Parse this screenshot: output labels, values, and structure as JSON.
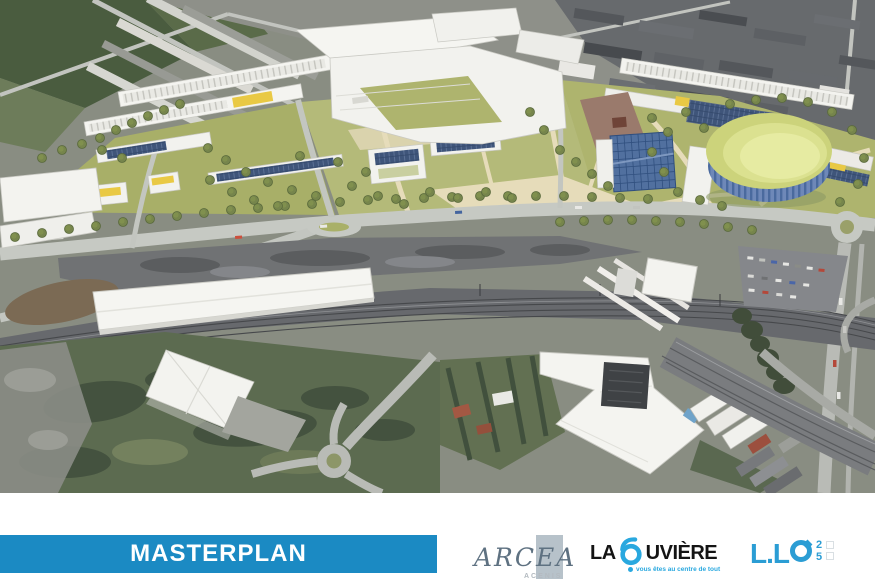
{
  "slide": {
    "title_bar": {
      "label": "MASTERPLAN",
      "background": "#1b8ac3",
      "text_color": "#ffffff"
    },
    "render_alt": "Aerial 3D masterplan render: new housing rows with yellow and solar roofs, central park with trees, oval arena with yellow-green roof and blue striped facade, blue glass hall, tree-lined boulevard, railway corridor with long white warehouse, brownfield, roundabouts and surrounding town"
  },
  "logos": {
    "arcea": {
      "name": "ARCEA",
      "subtext": "ACENIS",
      "text_color": "#5e7181",
      "block_color": "#b7c2ca"
    },
    "la_louviere": {
      "prefix": "LA",
      "suffix": "UVIÈRE",
      "tagline": "vous êtes au centre de tout",
      "accent": "#29a8df",
      "text_color": "#141414"
    },
    "llo": {
      "prefix": "L.L",
      "full_text": "L.LO",
      "digits_top": "2",
      "digits_bottom": "5",
      "color": "#2b9dd4"
    }
  },
  "render_palette": {
    "lawn_green": "#aeb46e",
    "esplanade_beige": "#e6dcba",
    "building_white": "#f4f4f0",
    "roof_yellow": "#e9c944",
    "solar_panel_blue": "#3f557a",
    "arena_roof_green": "#dbe190",
    "arena_facade_blue": "#6e88b8",
    "road_grey": "#c6c9c3",
    "railway_grey": "#67696d",
    "scrub_green": "#5c6b50"
  }
}
